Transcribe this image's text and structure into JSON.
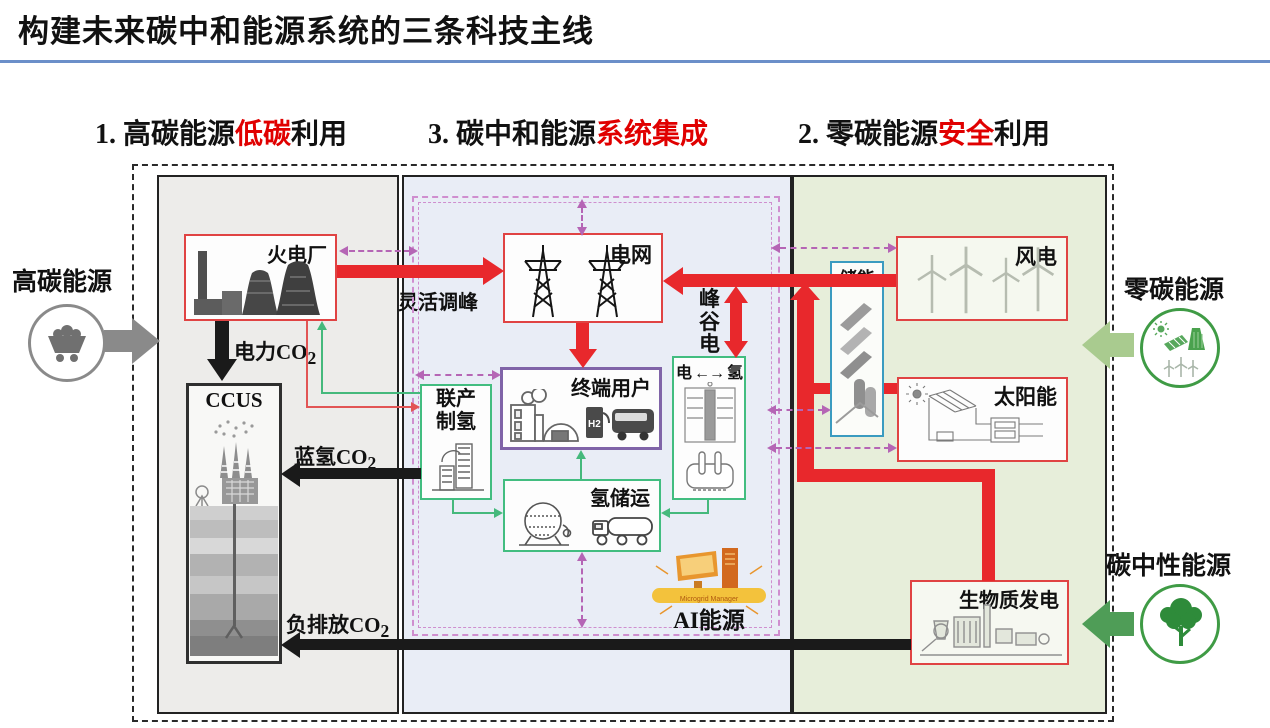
{
  "title": "构建未来碳中和能源系统的三条科技主线",
  "headers": [
    {
      "prefix": "1. 高碳能源",
      "highlight": "低碳",
      "suffix": "利用"
    },
    {
      "prefix": "3. 碳中和能源",
      "highlight": "系统集成",
      "suffix": ""
    },
    {
      "prefix": "2. 零碳能源",
      "highlight": "安全",
      "suffix": "利用"
    }
  ],
  "externals": {
    "high_carbon": {
      "label": "高碳能源",
      "icon": "coal-cart-icon"
    },
    "zero_carbon": {
      "label": "零碳能源",
      "icon": "renewables-icon"
    },
    "carbon_neutral": {
      "label": "碳中性能源",
      "icon": "tree-icon"
    }
  },
  "boxes": {
    "thermal": {
      "label": "火电厂"
    },
    "ccus": {
      "label": "CCUS"
    },
    "grid": {
      "label": "电网"
    },
    "end_user": {
      "label": "终端用户",
      "h2_pump_text": "H2"
    },
    "h2_production": {
      "line1": "联产",
      "line2": "制氢"
    },
    "h2_storage": {
      "label": "氢储运"
    },
    "elec_h2": {
      "label": "电 ←→ 氢"
    },
    "ai": {
      "label": "AI能源",
      "banner": "Microgrid Manager"
    },
    "storage": {
      "label": "储能"
    },
    "wind": {
      "label": "风电"
    },
    "solar": {
      "label": "太阳能"
    },
    "biomass": {
      "label": "生物质发电"
    }
  },
  "flows": {
    "flexible_peaking": "灵活调峰",
    "peak_valley_power": "峰谷电",
    "power_co2": {
      "text": "电力CO",
      "sub": "2"
    },
    "blue_h2_co2": {
      "text": "蓝氢CO",
      "sub": "2"
    },
    "negative_emission_co2": {
      "text": "负排放CO",
      "sub": "2"
    }
  },
  "colors": {
    "title_rule_blue": "#6b8fc9",
    "highlight_red": "#e00000",
    "arrow_red": "#e8282c",
    "box_border_red": "#e04343",
    "hydrogen_green": "#42bd80",
    "end_user_purple": "#8064a8",
    "storage_blue": "#3a9bc0",
    "dashed_purple": "#b565b5",
    "panel_left_gray": "#edecea",
    "panel_mid_blue": "#e9edf6",
    "panel_right_green": "#e7eeda"
  }
}
